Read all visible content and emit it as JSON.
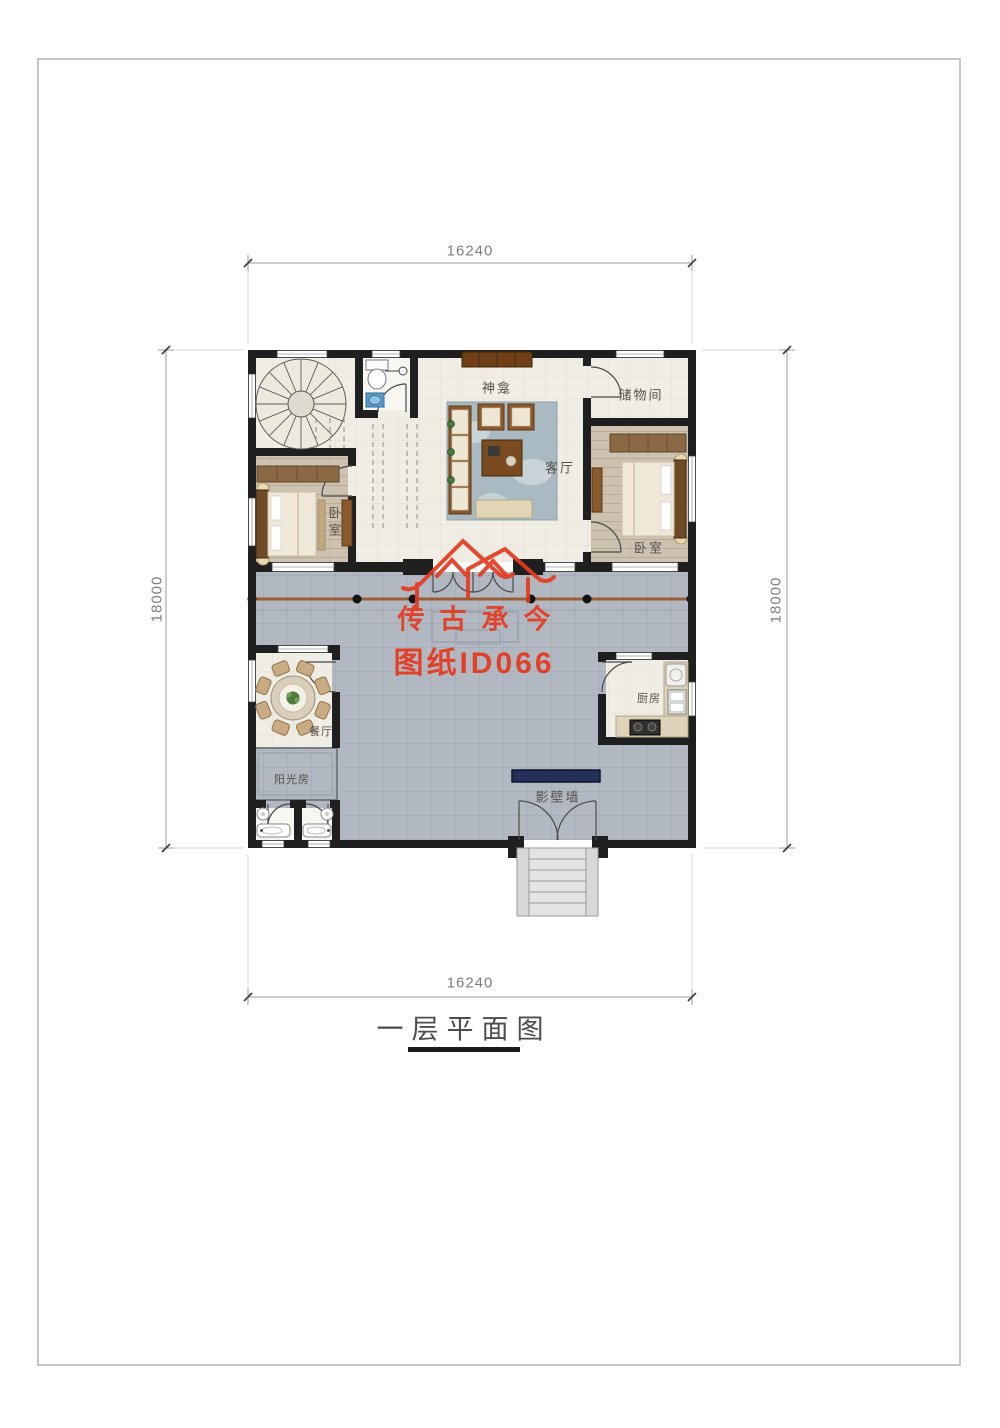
{
  "sheet": {
    "title": "一层平面图"
  },
  "dimensions": {
    "top": "16240",
    "bottom": "16240",
    "left": "18000",
    "right": "18000"
  },
  "rooms": {
    "shrine": "神龛",
    "storage": "储物间",
    "living": "客厅",
    "bedroom_left": "卧室",
    "bedroom_right": "卧室",
    "dining": "餐厅",
    "sunroom": "阳光房",
    "kitchen": "厨房",
    "screen_wall": "影壁墙"
  },
  "watermark": {
    "brand": "传古承今",
    "sheet_id": "图纸ID066"
  },
  "colors": {
    "wall": "#1f1f1f",
    "room_floor": "#f0ede4",
    "courtyard": "#b2b8c1",
    "wood_floor": "#cdc2b0",
    "beam_brown": "#9b5b36",
    "watermark_red": "#e43b20",
    "screen_wall_navy": "#22305a"
  }
}
